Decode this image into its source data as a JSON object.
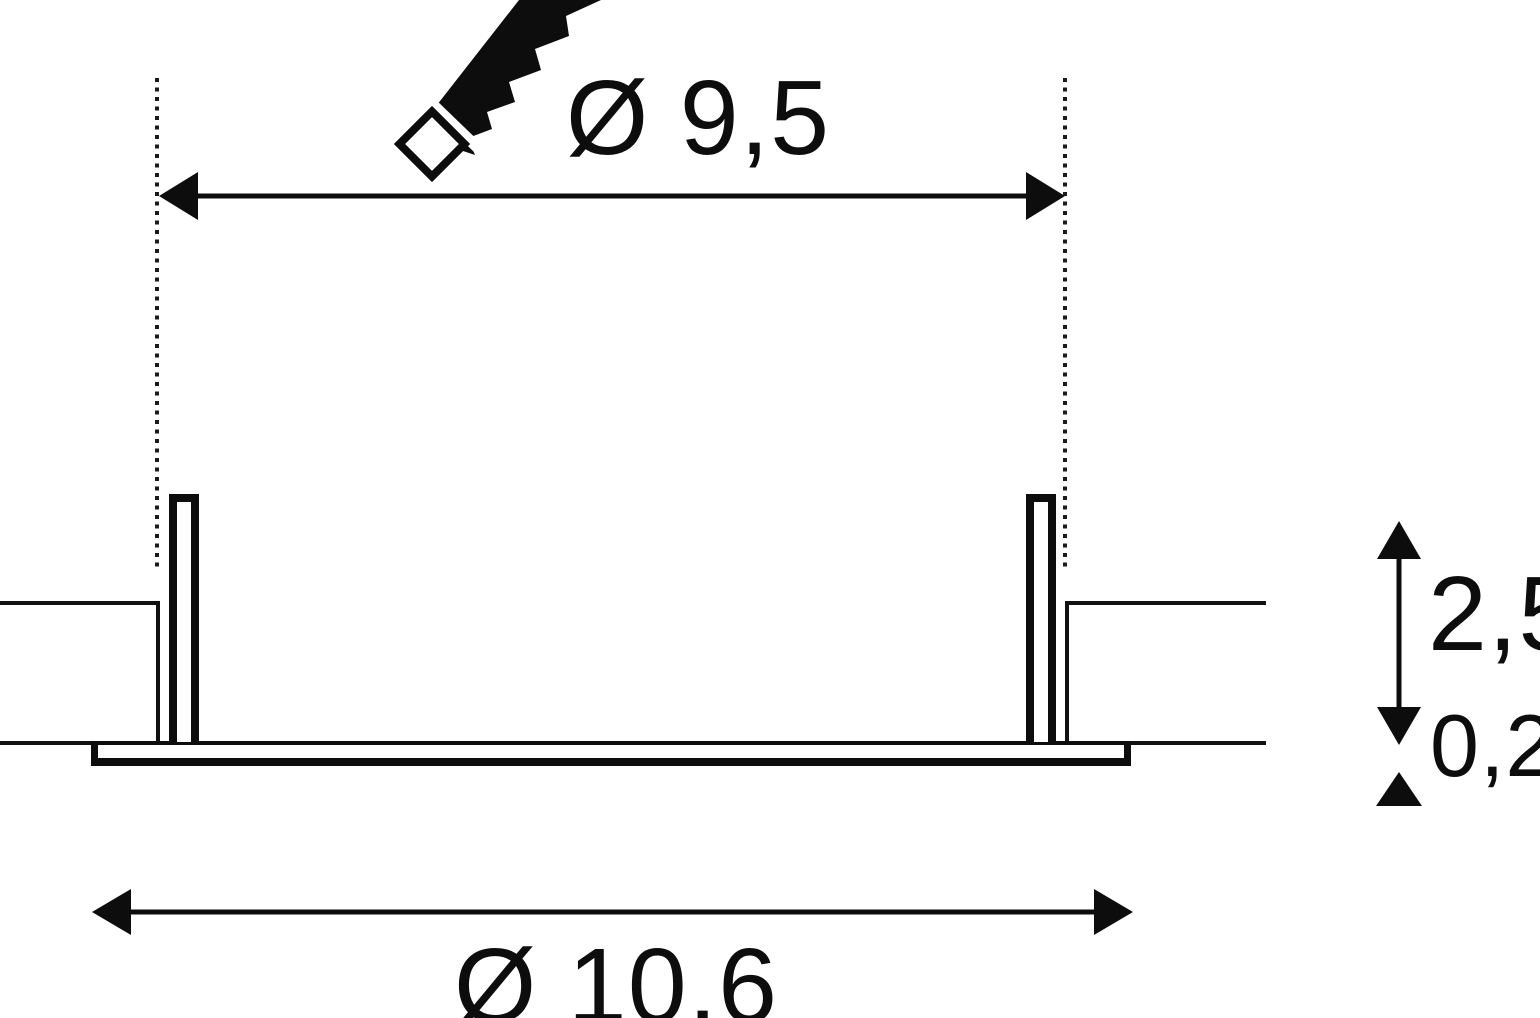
{
  "dimensions": {
    "cutout_diameter": "Ø 9,5",
    "recess_depth": "2,5",
    "flange_thickness": "0,2",
    "flange_diameter": "Ø 10,6"
  },
  "icons": {
    "saw": "jab-saw"
  },
  "colors": {
    "line": "#0d0d0d",
    "background": "#ffffff"
  }
}
